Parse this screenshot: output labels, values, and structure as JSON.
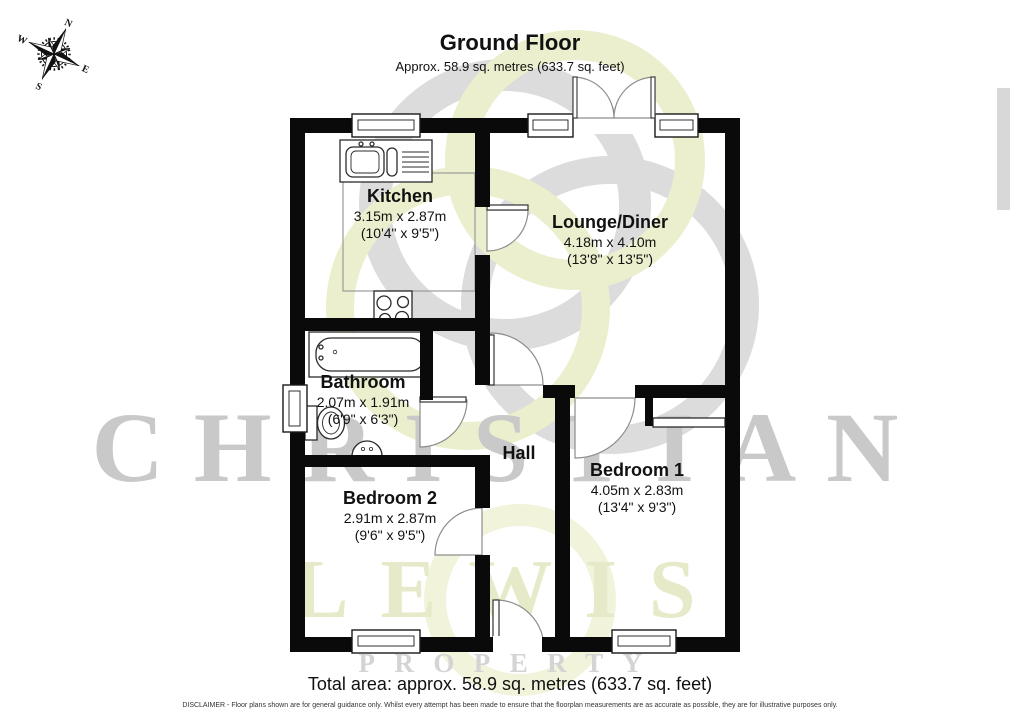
{
  "header": {
    "title": "Ground Floor",
    "subtitle": "Approx. 58.9 sq. metres (633.7 sq. feet)"
  },
  "rooms": [
    {
      "name": "Kitchen",
      "dims_metric": "3.15m x 2.87m",
      "dims_imperial": "(10'4\" x 9'5\")"
    },
    {
      "name": "Lounge/Diner",
      "dims_metric": "4.18m x 4.10m",
      "dims_imperial": "(13'8\" x 13'5\")"
    },
    {
      "name": "Bathroom",
      "dims_metric": "2.07m x 1.91m",
      "dims_imperial": "(6'9\" x 6'3\")"
    },
    {
      "name": "Hall"
    },
    {
      "name": "Bedroom 1",
      "dims_metric": "4.05m x 2.83m",
      "dims_imperial": "(13'4\" x 9'3\")"
    },
    {
      "name": "Bedroom 2",
      "dims_metric": "2.91m x 2.87m",
      "dims_imperial": "(9'6\" x 9'5\")"
    }
  ],
  "compass": {
    "n": "N",
    "e": "E",
    "s": "S",
    "w": "W"
  },
  "watermark": {
    "line1": "CHRISTIAN",
    "line2": "LEWIS",
    "line3": "PROPERTY"
  },
  "footer": {
    "total_area": "Total area: approx. 58.9 sq. metres (633.7 sq. feet)",
    "disclaimer": "DISCLAIMER -  Floor plans shown are for general guidance only. Whilst every attempt has been made to ensure that the floorplan measurements are as accurate as possible, they are for illustrative purposes only."
  },
  "colors": {
    "wall": "#0a0a0a",
    "watermark_gray": "#c9c9c9",
    "watermark_olive": "#e7eac9",
    "fixture_line": "#333333"
  }
}
